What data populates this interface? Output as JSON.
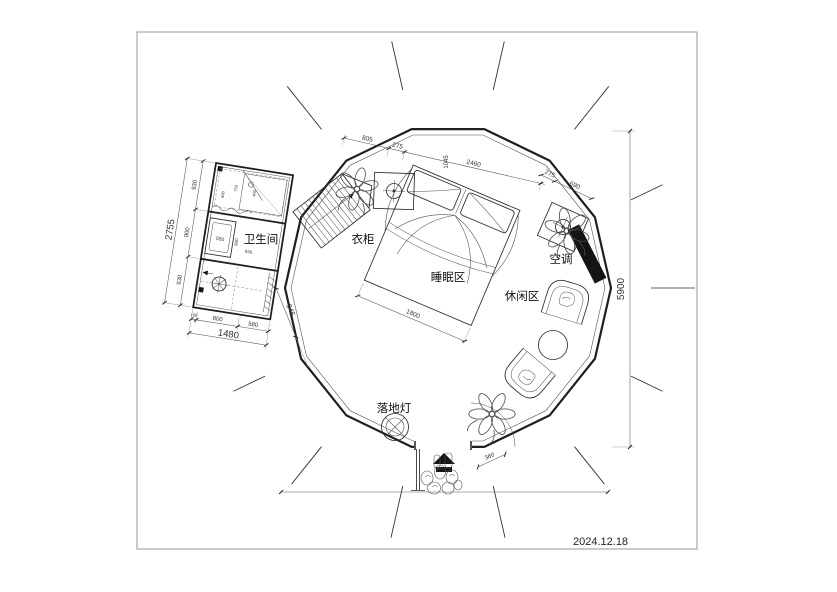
{
  "meta": {
    "date": "2024.12.18"
  },
  "labels": {
    "bathroom": "卫生间",
    "wardrobe": "衣柜",
    "sleeping_area": "睡眠区",
    "leisure_area": "休闲区",
    "air_conditioner": "空调",
    "floor_lamp": "落地灯"
  },
  "dims": {
    "top": [
      "805",
      "275",
      "2460",
      "1045",
      "275",
      "690"
    ],
    "height_total": "5900",
    "bed_width": "1800",
    "door": "360",
    "annex_left": [
      "930",
      "900",
      "930"
    ],
    "annex_left_total": "2755",
    "annex_bottom": [
      "100",
      "800",
      "580"
    ],
    "annex_bottom_total": "1480",
    "annex_right": "945",
    "annex_inner": [
      "800",
      "750",
      "400",
      "550",
      "900",
      "930"
    ]
  }
}
